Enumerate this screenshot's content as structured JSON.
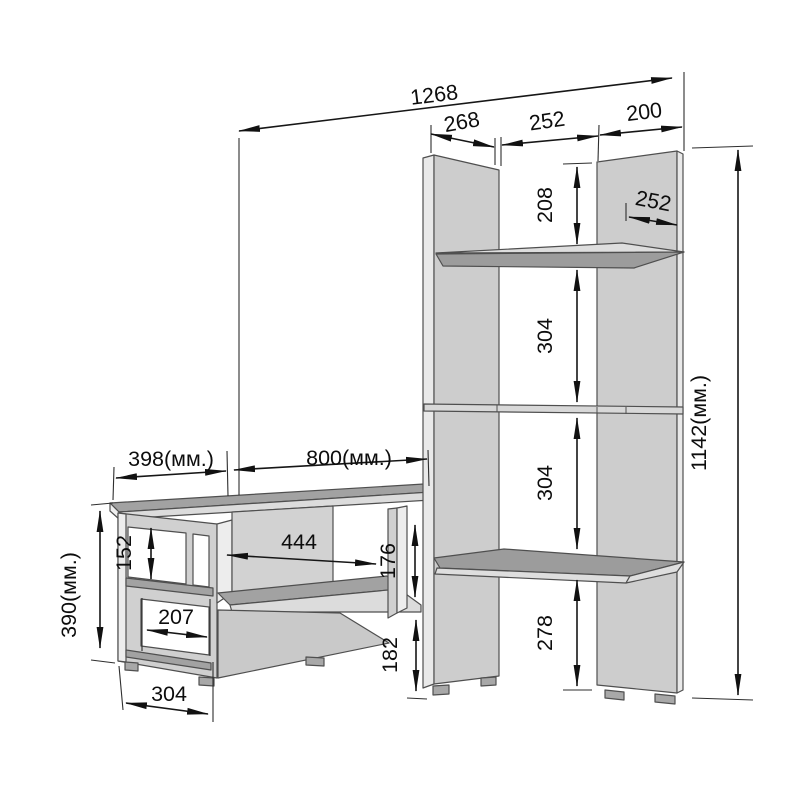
{
  "page": {
    "background": "#ffffff"
  },
  "drawing": {
    "units_suffix": "(мм.)",
    "labels": {
      "overall_width": "1268",
      "left_panel_depth": "268",
      "panel_gap": "252",
      "right_panel_top": "200",
      "right_panel_depth": "252",
      "gap_top": "208",
      "gap_upper": "304",
      "gap_lower": "304",
      "gap_bottom": "278",
      "unit_height": "1142(мм.)",
      "stand_left_width": "398(мм.)",
      "stand_right_width": "800(мм.)",
      "stand_height": "390(мм.)",
      "opening_width": "444",
      "left_opening_height": "152",
      "right_opening_height": "176",
      "under_clearance": "182",
      "lower_opening_width": "207",
      "base_width": "304"
    },
    "colors": {
      "panel_face": "#cdcdcd",
      "panel_edge": "#e9e9e9",
      "surface_dark": "#9c9c9c",
      "surface_top": "#a2a2a2",
      "light_edge": "#dcdcdc",
      "interior": "#ffffff",
      "outline": "#4f4f4f",
      "dimension_line": "#161616"
    }
  }
}
